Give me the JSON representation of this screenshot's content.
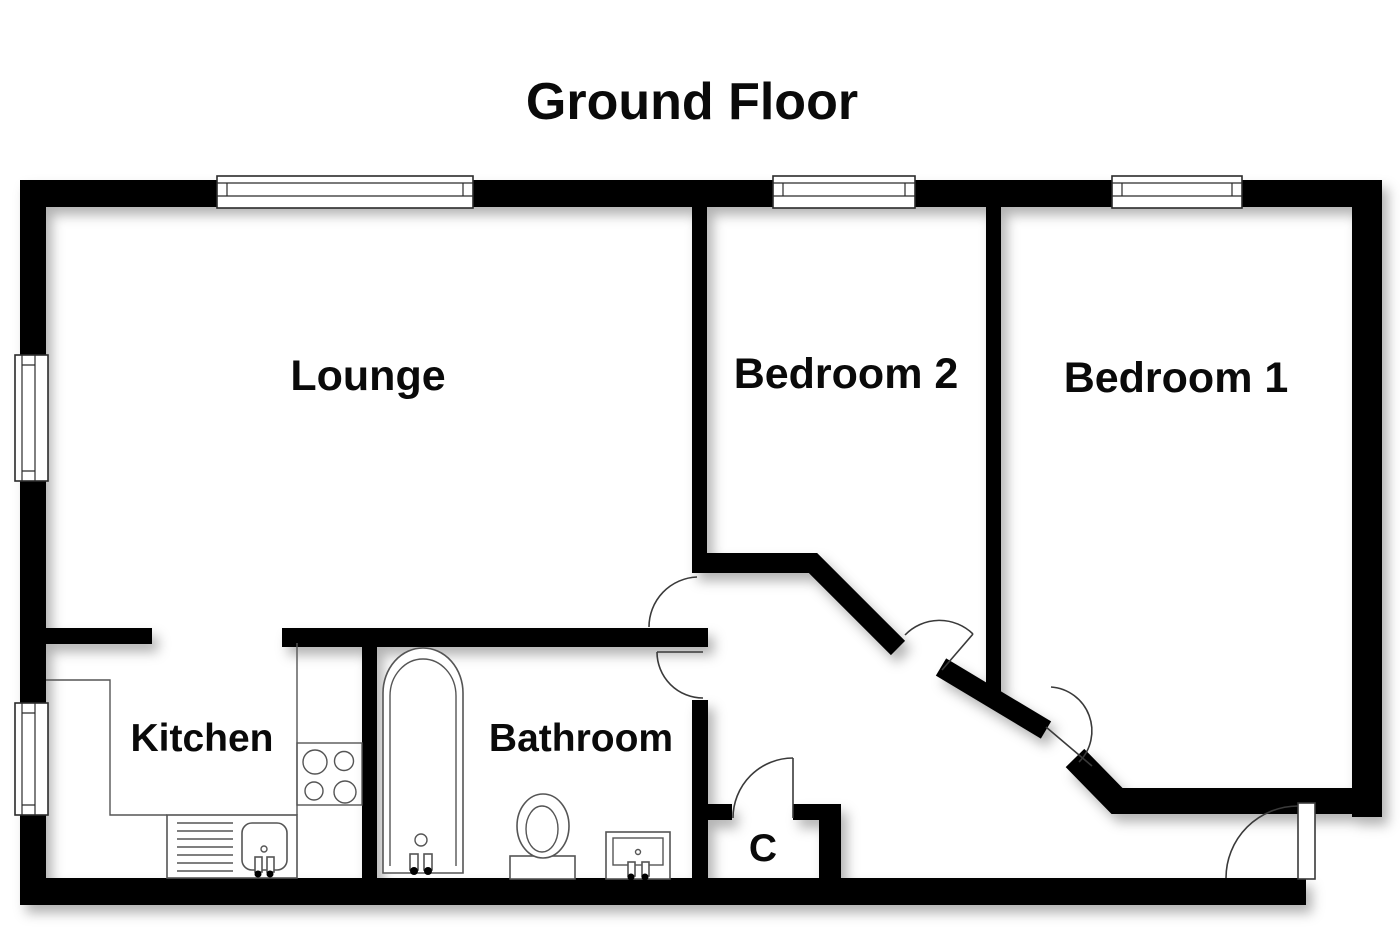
{
  "title": "Ground Floor",
  "floor_plan": {
    "rooms": [
      {
        "id": "lounge",
        "label": "Lounge"
      },
      {
        "id": "bedroom-2",
        "label": "Bedroom 2"
      },
      {
        "id": "bedroom-1",
        "label": "Bedroom 1"
      },
      {
        "id": "kitchen",
        "label": "Kitchen"
      },
      {
        "id": "bathroom",
        "label": "Bathroom"
      },
      {
        "id": "cupboard",
        "label": "C"
      }
    ],
    "fixtures": [
      "bathtub",
      "toilet",
      "basin",
      "kitchen-sink",
      "drainer",
      "hob",
      "kitchen-counter"
    ],
    "openings": {
      "windows": 5,
      "doors": 6,
      "open-doorways": 1
    }
  },
  "colors": {
    "wall": "#000000",
    "background": "#ffffff",
    "door_line": "#3a3a3a",
    "fixture_line": "#555555",
    "text": "#0a0a0a"
  }
}
